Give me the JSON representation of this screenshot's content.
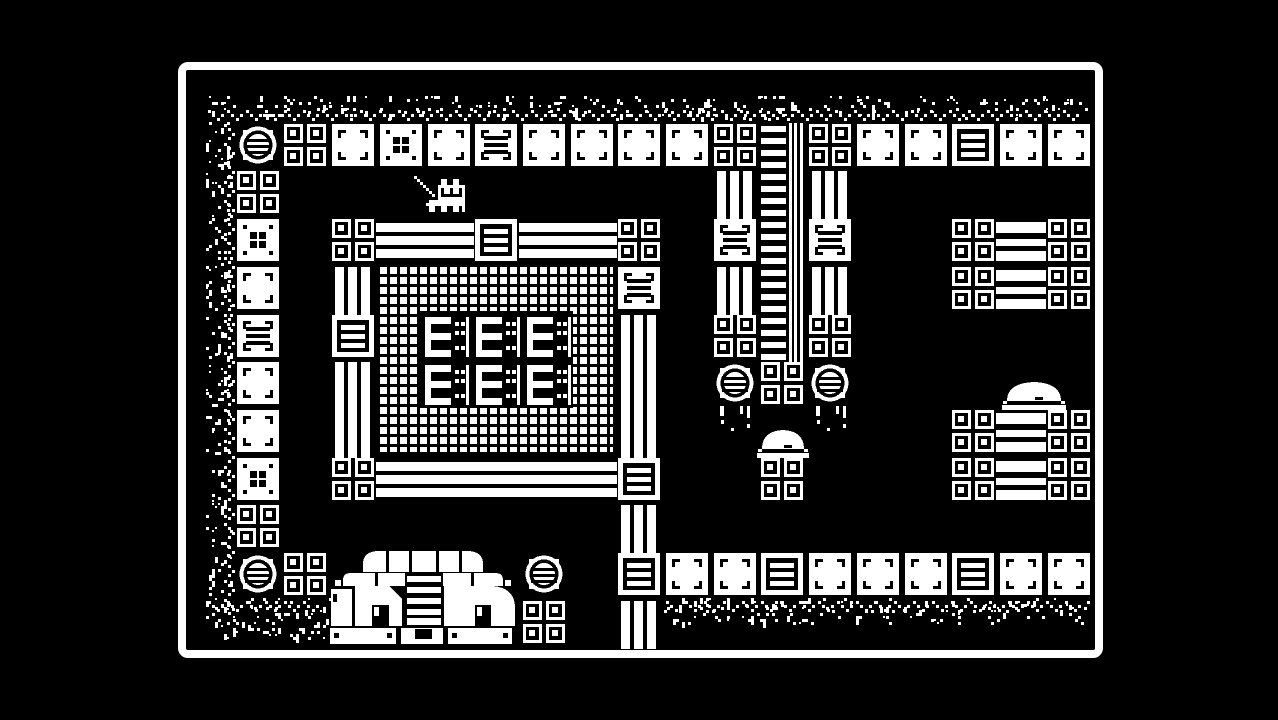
{
  "meta": {
    "app": "1-bit monochrome adventure game (Minit-style)",
    "scene_label": "Factory courtyard room: walled chamber with fenced generator building, ladder column, barrel pillars, conveyor stacks, temple structure and player cat holding a sword",
    "visible_text": []
  },
  "colors": {
    "background": "#000000",
    "foreground": "#ffffff"
  },
  "frame": {
    "x": 178,
    "y": 62,
    "width": 925,
    "height": 596,
    "border": 8,
    "radius": 10
  },
  "grid": {
    "origin_x": 189,
    "origin_y": 76,
    "pitch": 47.7,
    "tile": 42
  },
  "tiles": [
    [
      "barrel",
      1,
      1
    ],
    [
      "minisq",
      2,
      1
    ],
    [
      "block",
      3,
      1
    ],
    [
      "dots",
      4,
      1
    ],
    [
      "block",
      5,
      1
    ],
    [
      "crate",
      6,
      1
    ],
    [
      "block",
      7,
      1
    ],
    [
      "block",
      8,
      1
    ],
    [
      "block",
      9,
      1
    ],
    [
      "block",
      10,
      1
    ],
    [
      "minisq",
      11,
      1
    ],
    [
      "minisq",
      13,
      1
    ],
    [
      "block",
      14,
      1
    ],
    [
      "block",
      15,
      1
    ],
    [
      "cratef",
      16,
      1
    ],
    [
      "block",
      17,
      1
    ],
    [
      "block",
      18,
      1
    ],
    [
      "minisq",
      1,
      2
    ],
    [
      "dots",
      1,
      3
    ],
    [
      "block",
      1,
      4
    ],
    [
      "crate",
      1,
      5
    ],
    [
      "block",
      1,
      6
    ],
    [
      "block",
      1,
      7
    ],
    [
      "dots",
      1,
      8
    ],
    [
      "minisq",
      1,
      9
    ],
    [
      "barrel",
      1,
      10
    ],
    [
      "minisq",
      3,
      3
    ],
    [
      "hbars",
      4,
      3
    ],
    [
      "hbars",
      5,
      3
    ],
    [
      "cratef",
      6,
      3
    ],
    [
      "hbars",
      7,
      3
    ],
    [
      "hbars",
      8,
      3
    ],
    [
      "vbars",
      3,
      4
    ],
    [
      "cratef",
      3,
      5
    ],
    [
      "vbars",
      3,
      6
    ],
    [
      "vbars",
      3,
      7
    ],
    [
      "minisq",
      3,
      8
    ],
    [
      "hbars",
      4,
      8
    ],
    [
      "hbars",
      5,
      8
    ],
    [
      "hbars",
      6,
      8
    ],
    [
      "hbars",
      7,
      8
    ],
    [
      "hbars",
      8,
      8
    ],
    [
      "minisq",
      9,
      3
    ],
    [
      "crate",
      9,
      4
    ],
    [
      "vbars",
      9,
      5
    ],
    [
      "vbars",
      9,
      6
    ],
    [
      "vbars",
      9,
      7
    ],
    [
      "cratef",
      9,
      8
    ],
    [
      "vbars",
      9,
      9
    ],
    [
      "cratef",
      9,
      10
    ],
    [
      "vbars",
      9,
      11
    ],
    [
      "vbars",
      11,
      2
    ],
    [
      "crate",
      11,
      3
    ],
    [
      "vbars",
      11,
      4
    ],
    [
      "minisq",
      11,
      5
    ],
    [
      "barrel",
      11,
      6
    ],
    [
      "vbars",
      13,
      2
    ],
    [
      "crate",
      13,
      3
    ],
    [
      "vbars",
      13,
      4
    ],
    [
      "minisq",
      13,
      5
    ],
    [
      "barrel",
      13,
      6
    ],
    [
      "minisq",
      12,
      6
    ],
    [
      "minisq",
      12,
      8
    ],
    [
      "minisq",
      16,
      3
    ],
    [
      "conveyor",
      17,
      3
    ],
    [
      "minisq",
      18,
      3
    ],
    [
      "minisq",
      16,
      4
    ],
    [
      "conveyor",
      17,
      4
    ],
    [
      "minisq",
      18,
      4
    ],
    [
      "minisq",
      16,
      7
    ],
    [
      "conveyor",
      17,
      7
    ],
    [
      "minisq",
      18,
      7
    ],
    [
      "minisq",
      16,
      8
    ],
    [
      "conveyor",
      17,
      8
    ],
    [
      "minisq",
      18,
      8
    ],
    [
      "minisq",
      2,
      10
    ],
    [
      "barrel",
      7,
      10
    ],
    [
      "block",
      10,
      10
    ],
    [
      "block",
      11,
      10
    ],
    [
      "cratef",
      12,
      10
    ],
    [
      "block",
      13,
      10
    ],
    [
      "block",
      14,
      10
    ],
    [
      "block",
      15,
      10
    ],
    [
      "cratef",
      16,
      10
    ],
    [
      "block",
      17,
      10
    ],
    [
      "block",
      18,
      10
    ],
    [
      "minisq",
      7,
      11
    ]
  ],
  "objects": {
    "ladder": {
      "x": 761,
      "y": 123,
      "width": 42,
      "height": 239
    },
    "fence": {
      "x": 380,
      "y": 267,
      "width": 233,
      "height": 185
    },
    "vent_panel": {
      "x": 420,
      "y": 311,
      "width": 153,
      "height": 97,
      "unit_xs": [
        425,
        476,
        527
      ],
      "unit_ys": [
        317,
        365
      ],
      "unit_w": 44,
      "unit_h": 40
    },
    "domes": [
      {
        "x": 757,
        "y": 426,
        "width": 52,
        "height": 32
      },
      {
        "x": 1002,
        "y": 378,
        "width": 64,
        "height": 32
      }
    ],
    "drips": [
      {
        "x": 714,
        "y": 404
      },
      {
        "x": 810,
        "y": 404
      }
    ],
    "temple": {
      "x": 329,
      "y": 548,
      "width": 188,
      "height": 97
    }
  },
  "speckle_bands": [
    {
      "name": "top-edge",
      "x": 206,
      "y": 96,
      "width": 886,
      "height": 26,
      "count": 240,
      "seed": 11,
      "motif": "h-bottom"
    },
    {
      "name": "left-edge",
      "x": 206,
      "y": 122,
      "width": 31,
      "height": 498,
      "count": 180,
      "seed": 22,
      "motif": "v-right"
    },
    {
      "name": "bottom-left",
      "x": 206,
      "y": 598,
      "width": 128,
      "height": 46,
      "count": 80,
      "seed": 33,
      "motif": "h-top"
    },
    {
      "name": "bottom-right",
      "x": 664,
      "y": 598,
      "width": 428,
      "height": 30,
      "count": 140,
      "seed": 44,
      "motif": "h-top"
    }
  ],
  "player": {
    "x": 414,
    "y": 176,
    "pixel_size": 3,
    "facing": "left",
    "item": "sword",
    "bitmap": [
      "X................",
      ".X.......XX..XX..",
      "..X......XX..XX..",
      "...X....XXXXXXXXX",
      "....X...X.XX.XX.X",
      ".....X..X.XX.XX.X",
      "......X.X.......X",
      "........XXXXXXXXX",
      ".....XXXXXXXXXXXX",
      "....XXXXXXXXXXXXX",
      ".....XX..XX..XX.X",
      ".....XX..XX..XX.X"
    ]
  }
}
